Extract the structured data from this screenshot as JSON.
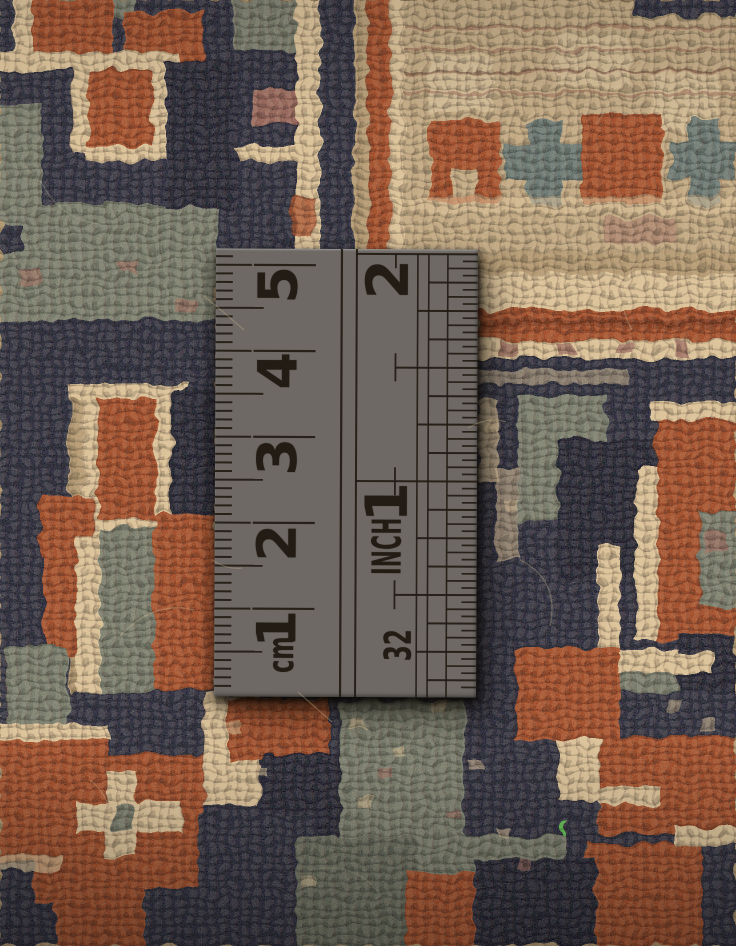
{
  "scene": {
    "subject": "Close-up photograph of a hand-knotted wool carpet with a geometric tribal pattern, measured with a steel ruler lying on the pile",
    "carpet_description": "Coarse wool knots in navy blue, rust red, sage green, cream and tan forming stepped latch-hook motifs, a rust border band and cross-shaped ornaments",
    "palette": {
      "navy": "#1b1e33",
      "navy2": "#121427",
      "cream": "#d8bd92",
      "cream2": "#e6d0a8",
      "tan": "#ab9068",
      "tan2": "#bca27a",
      "rust": "#9c3f1a",
      "rust2": "#7a2c11",
      "sage": "#6c7263",
      "sage2": "#585e51",
      "rose": "#8f5a50",
      "teal": "#5c6c6a",
      "wine": "#6e3328",
      "fiber_green": "#49c93e"
    }
  },
  "ruler": {
    "type": "stainless steel rule",
    "metal_color": "#6e6965",
    "marking_color": "#221c14",
    "cm_numbers": [
      "1",
      "2",
      "3",
      "4",
      "5"
    ],
    "cm_unit_label": "cm",
    "inch_numbers": [
      "1",
      "2"
    ],
    "inch_unit_label": "INCH",
    "inch_fraction_label": "32"
  }
}
